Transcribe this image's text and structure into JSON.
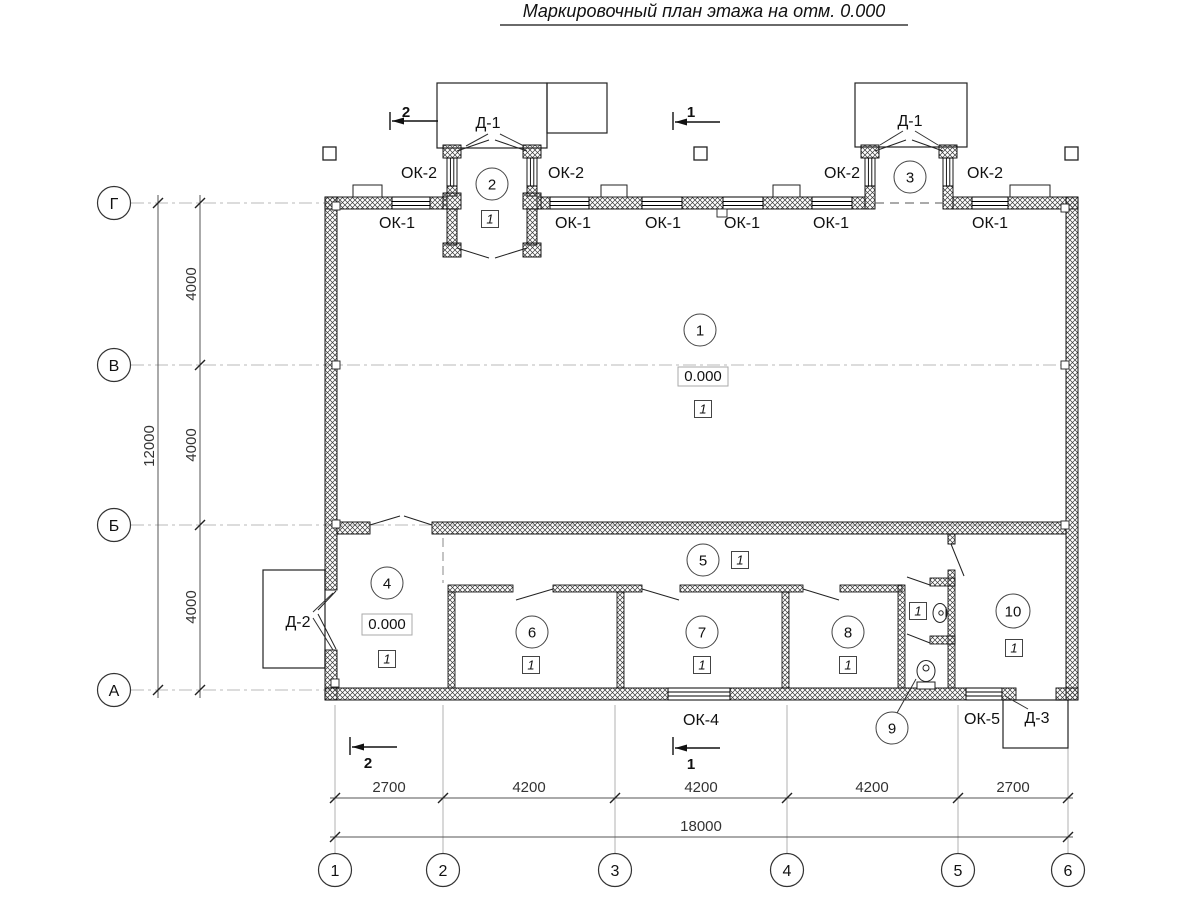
{
  "title": "Маркировочный план этажа на отм. 0.000",
  "row_axes": [
    "Г",
    "В",
    "Б",
    "А"
  ],
  "col_axes": [
    "1",
    "2",
    "3",
    "4",
    "5",
    "6"
  ],
  "dims": {
    "left_segments": [
      "4000",
      "4000",
      "4000"
    ],
    "left_total": "12000",
    "bottom_segments": [
      "2700",
      "4200",
      "4200",
      "4200",
      "2700"
    ],
    "bottom_total": "18000"
  },
  "rooms": [
    "1",
    "2",
    "3",
    "4",
    "5",
    "6",
    "7",
    "8",
    "9",
    "10"
  ],
  "type_marker": "1",
  "elevation": "0.000",
  "labels": {
    "door1": "Д-1",
    "door2": "Д-2",
    "door3": "Д-3",
    "window1": "ОК-1",
    "window2": "ОК-2",
    "window4": "ОК-4",
    "window5": "ОК-5"
  },
  "sections": {
    "s1": "1",
    "s2": "2"
  }
}
